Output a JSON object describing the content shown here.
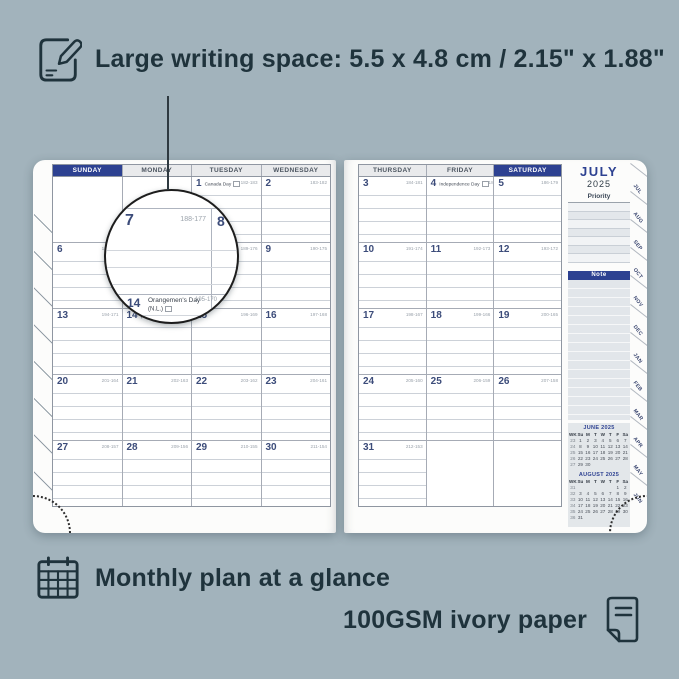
{
  "colors": {
    "background": "#a2b3bc",
    "ink": "#1f333c",
    "navy": "#2d4191",
    "day_number": "#3c4c7a",
    "annotation_gray": "#9aa2ab"
  },
  "top_annotation": {
    "icon": "pencil-note-icon",
    "text": "Large writing space: 5.5 x 4.8 cm / 2.15\" x 1.88\""
  },
  "bottom_annotations": {
    "monthly": {
      "icon": "calendar-grid-icon",
      "text": "Monthly plan at a glance"
    },
    "paper": {
      "icon": "paper-icon",
      "text": "100GSM ivory paper"
    }
  },
  "left_page": {
    "headers": [
      {
        "label": "SUNDAY",
        "highlight": true
      },
      {
        "label": "MONDAY",
        "highlight": false
      },
      {
        "label": "TUESDAY",
        "highlight": false
      },
      {
        "label": "WEDNESDAY",
        "highlight": false
      }
    ],
    "rows": [
      [
        {},
        {},
        {
          "day": "1",
          "note": "Canada Day",
          "flag": true,
          "ann": "182-183"
        },
        {
          "day": "2",
          "ann": "183-182"
        }
      ],
      [
        {
          "day": "6",
          "ann": "187-178"
        },
        {
          "day": "7",
          "ann": "188-177"
        },
        {
          "day": "8",
          "ann": "189-176"
        },
        {
          "day": "9",
          "ann": "190-175"
        }
      ],
      [
        {
          "day": "13",
          "ann": "194-171"
        },
        {
          "day": "14",
          "note": "(N.L.)",
          "flag": true,
          "ann": "195-170"
        },
        {
          "day": "15",
          "ann": "196-169"
        },
        {
          "day": "16",
          "ann": "197-168"
        }
      ],
      [
        {
          "day": "20",
          "ann": "201-164"
        },
        {
          "day": "21",
          "ann": "202-163"
        },
        {
          "day": "22",
          "ann": "203-162"
        },
        {
          "day": "23",
          "ann": "204-161"
        }
      ],
      [
        {
          "day": "27",
          "ann": "208-157"
        },
        {
          "day": "28",
          "ann": "209-156"
        },
        {
          "day": "29",
          "ann": "210-155"
        },
        {
          "day": "30",
          "ann": "211-154"
        }
      ]
    ]
  },
  "right_page": {
    "headers": [
      {
        "label": "THURSDAY",
        "highlight": false
      },
      {
        "label": "FRIDAY",
        "highlight": false
      },
      {
        "label": "SATURDAY",
        "highlight": true
      }
    ],
    "rows": [
      [
        {
          "day": "3",
          "ann": "184-181"
        },
        {
          "day": "4",
          "note": "Independence Day",
          "flag": true,
          "ann": "185-180"
        },
        {
          "day": "5",
          "ann": "186-179"
        }
      ],
      [
        {
          "day": "10",
          "ann": "191-174"
        },
        {
          "day": "11",
          "ann": "192-173"
        },
        {
          "day": "12",
          "ann": "193-172"
        }
      ],
      [
        {
          "day": "17",
          "ann": "198-167"
        },
        {
          "day": "18",
          "ann": "199-166"
        },
        {
          "day": "19",
          "ann": "200-165"
        }
      ],
      [
        {
          "day": "24",
          "ann": "205-160"
        },
        {
          "day": "25",
          "ann": "206-159"
        },
        {
          "day": "26",
          "ann": "207-158"
        }
      ],
      [
        {
          "day": "31",
          "ann": "212-153"
        },
        {},
        {}
      ]
    ]
  },
  "sidebar": {
    "month": "JULY",
    "year": "2025",
    "priority_label": "Priority",
    "note_label": "Note",
    "mini_calendars": [
      {
        "title": "JUNE 2025",
        "headers": [
          "WK",
          "Su",
          "M",
          "T",
          "W",
          "T",
          "F",
          "Sa"
        ],
        "rows": [
          [
            "23",
            "1",
            "2",
            "3",
            "4",
            "5",
            "6",
            "7"
          ],
          [
            "24",
            "8",
            "9",
            "10",
            "11",
            "12",
            "13",
            "14"
          ],
          [
            "25",
            "15",
            "16",
            "17",
            "18",
            "19",
            "20",
            "21"
          ],
          [
            "26",
            "22",
            "23",
            "24",
            "25",
            "26",
            "27",
            "28"
          ],
          [
            "27",
            "29",
            "30",
            "",
            "",
            "",
            "",
            ""
          ]
        ]
      },
      {
        "title": "AUGUST 2025",
        "headers": [
          "WK",
          "Su",
          "M",
          "T",
          "W",
          "T",
          "F",
          "Sa"
        ],
        "rows": [
          [
            "31",
            "",
            "",
            "",
            "",
            "",
            "1",
            "2"
          ],
          [
            "32",
            "3",
            "4",
            "5",
            "6",
            "7",
            "8",
            "9"
          ],
          [
            "33",
            "10",
            "11",
            "12",
            "13",
            "14",
            "15",
            "16"
          ],
          [
            "34",
            "17",
            "18",
            "19",
            "20",
            "21",
            "22",
            "23"
          ],
          [
            "35",
            "24",
            "25",
            "26",
            "27",
            "28",
            "29",
            "30"
          ],
          [
            "36",
            "31",
            "",
            "",
            "",
            "",
            "",
            ""
          ]
        ]
      }
    ],
    "month_tabs": [
      "JUL",
      "AUG",
      "SEP",
      "OCT",
      "NOV",
      "DEC",
      "JAN",
      "FEB",
      "MAR",
      "APR",
      "MAY",
      "JUN"
    ]
  },
  "magnifier": {
    "day": "7",
    "annotation": "188-177",
    "adjacent_day": "8",
    "event_day": "14",
    "event_title": "Orangemen's Day",
    "event_subtitle": "(N.L.)",
    "event_annotation": "195-170"
  }
}
